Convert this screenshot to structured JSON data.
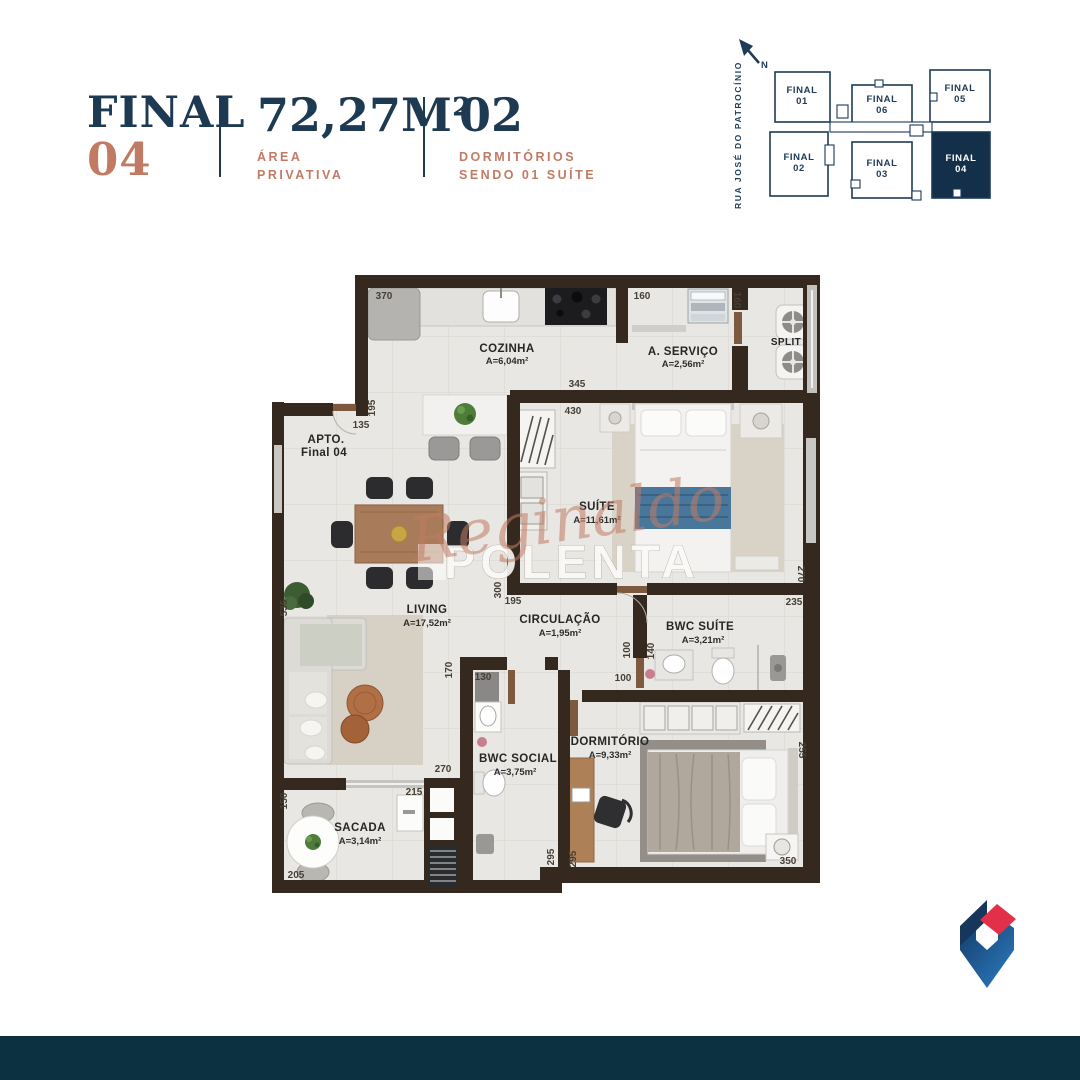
{
  "header": {
    "unit": {
      "label": "FINAL",
      "number": "04"
    },
    "area": {
      "value": "72,27M²",
      "caption_line1": "ÁREA",
      "caption_line2": "PRIVATIVA"
    },
    "bedrooms": {
      "value": "02",
      "caption_line1": "DORMITÓRIOS",
      "caption_line2": "SENDO 01 SUÍTE"
    }
  },
  "key_plan": {
    "north_label": "N",
    "street_name": "RUA JOSÉ DO PATROCÍNIO",
    "units": [
      {
        "label": "FINAL",
        "number": "01",
        "highlighted": false
      },
      {
        "label": "FINAL",
        "number": "06",
        "highlighted": false
      },
      {
        "label": "FINAL",
        "number": "05",
        "highlighted": false
      },
      {
        "label": "FINAL",
        "number": "02",
        "highlighted": false
      },
      {
        "label": "FINAL",
        "number": "03",
        "highlighted": false
      },
      {
        "label": "FINAL",
        "number": "04",
        "highlighted": true
      }
    ]
  },
  "floor_plan": {
    "apto_line1": "APTO.",
    "apto_line2": "Final 04",
    "rooms": [
      {
        "name": "COZINHA",
        "area": "A=6,04m²"
      },
      {
        "name": "A. SERVIÇO",
        "area": "A=2,56m²"
      },
      {
        "name": "SPLIT",
        "area": ""
      },
      {
        "name": "SUÍTE",
        "area": "A=11,61m²"
      },
      {
        "name": "LIVING",
        "area": "A=17,52m²"
      },
      {
        "name": "CIRCULAÇÃO",
        "area": "A=1,95m²"
      },
      {
        "name": "BWC SUÍTE",
        "area": "A=3,21m²"
      },
      {
        "name": "BWC SOCIAL",
        "area": "A=3,75m²"
      },
      {
        "name": "DORMITÓRIO",
        "area": "A=9,33m²"
      },
      {
        "name": "SACADA",
        "area": "A=3,14m²"
      }
    ],
    "dims": [
      "370",
      "160",
      "160",
      "345",
      "195",
      "135",
      "430",
      "300",
      "270",
      "535",
      "195",
      "235",
      "100",
      "140",
      "100",
      "170",
      "130",
      "270",
      "255",
      "215",
      "150",
      "205",
      "295",
      "295",
      "350"
    ]
  },
  "watermark": {
    "script": "Reginaldo",
    "block": "POLENTA"
  },
  "colors": {
    "navy": "#1D3A52",
    "coral": "#C17B64",
    "wall_brown": "#35291F",
    "floor": "#E9E7E3",
    "footer_bar": "#0C3242",
    "keyplan_highlight": "#132F4A",
    "logo_blue": "#2E7CC2",
    "logo_navy": "#16365C",
    "logo_red": "#E3304A"
  }
}
